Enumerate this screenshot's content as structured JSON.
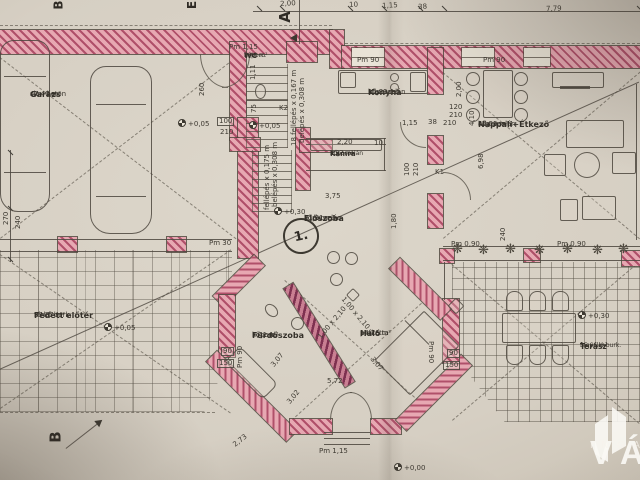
{
  "plan": {
    "rooms": [
      {
        "name": "Garázs",
        "material": "sim. beton",
        "area": "47,40 m²"
      },
      {
        "name": "WC",
        "material": "kőporc.",
        "area": "1,48 m²"
      },
      {
        "name": "Konyha",
        "material": "kőporcelán",
        "area": "10,89 m²"
      },
      {
        "name": "Kamra",
        "material": "kőporcelán",
        "area": "2,97 m²"
      },
      {
        "name": "Nappali+Étkező",
        "material": "kőporcelán",
        "area": "47,55 m²"
      },
      {
        "name": "Előszoba",
        "material": "kőporcelán",
        "area": "21,61 m²"
      },
      {
        "name": "Fürdőszoba",
        "material": "kőporc.",
        "area": "7,41 m²"
      },
      {
        "name": "Háló",
        "material": "parketta",
        "area": "14,76 m²"
      },
      {
        "name": "Fedett előtér",
        "material": "térkő burk.",
        "area": "37,27 m²"
      },
      {
        "name": "Terasz",
        "material": "fagyálló burk.",
        "area": "35,66 m²"
      }
    ],
    "markers": {
      "section_a": "A",
      "section_b": "B",
      "section_e": "E",
      "unit_number": "1."
    },
    "icons": {
      "plant": "❋"
    },
    "annotations": [
      {
        "t": "2,00",
        "x": 280,
        "y": 1,
        "r": -3
      },
      {
        "t": "10",
        "x": 349,
        "y": 2,
        "r": -3
      },
      {
        "t": "1,15",
        "x": 382,
        "y": 3,
        "r": -3
      },
      {
        "t": "38",
        "x": 418,
        "y": 4,
        "r": -3
      },
      {
        "t": "7,79",
        "x": 546,
        "y": 6,
        "r": -2
      },
      {
        "t": "Pm 1,15",
        "x": 229,
        "y": 44,
        "r": 0
      },
      {
        "t": "Pm 90",
        "x": 357,
        "y": 57,
        "r": 0
      },
      {
        "t": "Pm 90",
        "x": 483,
        "y": 57,
        "r": 0
      },
      {
        "t": "K2",
        "x": 279,
        "y": 105,
        "r": 0
      },
      {
        "t": "K1",
        "x": 435,
        "y": 169,
        "r": 0
      },
      {
        "t": "260",
        "x": 199,
        "y": 96,
        "r": -90
      },
      {
        "t": "1,11",
        "x": 250,
        "y": 80,
        "r": -90
      },
      {
        "t": "75",
        "x": 251,
        "y": 113,
        "r": -90
      },
      {
        "t": "2,00",
        "x": 456,
        "y": 97,
        "r": -90
      },
      {
        "t": "4,10",
        "x": 469,
        "y": 126,
        "r": -90
      },
      {
        "t": "120",
        "x": 449,
        "y": 104,
        "r": 0
      },
      {
        "t": "210",
        "x": 449,
        "y": 112,
        "r": 0
      },
      {
        "t": "1,15",
        "x": 402,
        "y": 120,
        "r": 0
      },
      {
        "t": "38",
        "x": 428,
        "y": 119,
        "r": 0
      },
      {
        "t": "210",
        "x": 443,
        "y": 120,
        "r": 0
      },
      {
        "t": "2,20",
        "x": 337,
        "y": 139,
        "r": 0
      },
      {
        "t": "10",
        "x": 374,
        "y": 140,
        "r": 0
      },
      {
        "t": "100",
        "x": 217,
        "y": 117,
        "r": 0,
        "box": true
      },
      {
        "t": "210",
        "x": 220,
        "y": 129,
        "r": 0
      },
      {
        "t": "100",
        "x": 404,
        "y": 176,
        "r": -90
      },
      {
        "t": "210",
        "x": 413,
        "y": 176,
        "r": -90
      },
      {
        "t": "1,80",
        "x": 391,
        "y": 229,
        "r": -90
      },
      {
        "t": "6,98",
        "x": 478,
        "y": 169,
        "r": -90
      },
      {
        "t": "3,75",
        "x": 325,
        "y": 193,
        "r": 0
      },
      {
        "t": "270",
        "x": 3,
        "y": 225,
        "r": -90
      },
      {
        "t": "240",
        "x": 15,
        "y": 229,
        "r": -90
      },
      {
        "t": "Pm 30",
        "x": 209,
        "y": 240,
        "r": 0
      },
      {
        "t": "Pm 0,90",
        "x": 451,
        "y": 241,
        "r": 0
      },
      {
        "t": "Pm 0,90",
        "x": 557,
        "y": 241,
        "r": 0
      },
      {
        "t": "240",
        "x": 500,
        "y": 241,
        "r": -90
      },
      {
        "t": "90",
        "x": 221,
        "y": 347,
        "r": 0,
        "box": true
      },
      {
        "t": "150",
        "x": 217,
        "y": 359,
        "r": 0,
        "box": true
      },
      {
        "t": "90",
        "x": 447,
        "y": 349,
        "r": 0,
        "box": true
      },
      {
        "t": "150",
        "x": 443,
        "y": 361,
        "r": 0,
        "box": true
      },
      {
        "t": "Pm 90",
        "x": 237,
        "y": 368,
        "r": -90
      },
      {
        "t": "Pm 90",
        "x": 434,
        "y": 341,
        "r": 90
      },
      {
        "t": "5,72",
        "x": 327,
        "y": 378,
        "r": 0
      },
      {
        "t": "3,02",
        "x": 286,
        "y": 401,
        "r": -50
      },
      {
        "t": "3,07",
        "x": 270,
        "y": 364,
        "r": -50
      },
      {
        "t": "3,07",
        "x": 374,
        "y": 356,
        "r": 50
      },
      {
        "t": "2,73",
        "x": 232,
        "y": 443,
        "r": -38
      },
      {
        "t": "Pm 1,15",
        "x": 319,
        "y": 448,
        "r": 0
      },
      {
        "t": "+0,00",
        "x": 394,
        "y": 463,
        "r": 0,
        "lvl": true
      },
      {
        "t": "+0,05",
        "x": 178,
        "y": 119,
        "r": 0,
        "lvl": true
      },
      {
        "t": "+0,05",
        "x": 249,
        "y": 121,
        "r": 0,
        "lvl": true
      },
      {
        "t": "+0,05",
        "x": 104,
        "y": 323,
        "r": 0,
        "lvl": true
      },
      {
        "t": "+0,30",
        "x": 274,
        "y": 207,
        "r": 0,
        "lvl": true
      },
      {
        "t": "+0,30",
        "x": 578,
        "y": 311,
        "r": 0,
        "lvl": true
      },
      {
        "t": "18 fellépés x 0,167 m",
        "x": 291,
        "y": 146,
        "r": -90
      },
      {
        "t": "belépés x 0,308 m",
        "x": 299,
        "y": 143,
        "r": -90
      },
      {
        "t": "fellépés x 0,175 m",
        "x": 264,
        "y": 210,
        "r": -90
      },
      {
        "t": "belépés x 0,308 m",
        "x": 272,
        "y": 207,
        "r": -90
      },
      {
        "t": "1,00 x 2,10",
        "x": 317,
        "y": 336,
        "r": -50
      },
      {
        "t": "1,00 x 2,10",
        "x": 345,
        "y": 296,
        "r": 50
      }
    ]
  },
  "logo": {
    "brand": "VÁROSI",
    "subtitle": "INGATLANIRODA"
  },
  "colors": {
    "paper": "#d7d1c5",
    "wall_fill": "#e7a8b2",
    "wall_hatch": "#b0506a",
    "line": "#4c463e",
    "logo_white": "#f5f3ef"
  }
}
